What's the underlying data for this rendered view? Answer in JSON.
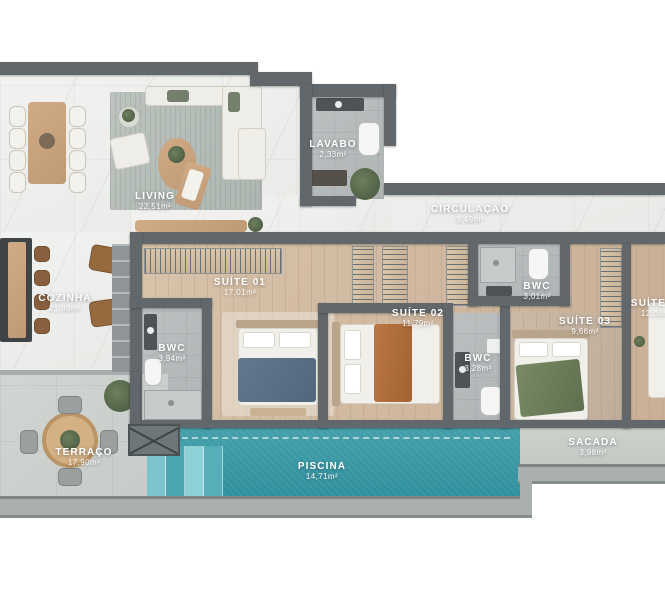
{
  "type": "floor_plan",
  "rooms": [
    {
      "id": "living",
      "label": "LIVING",
      "area": "22,51m²"
    },
    {
      "id": "lavabo",
      "label": "LAVABO",
      "area": "2,33m²"
    },
    {
      "id": "circulacao",
      "label": "CIRCULAÇÃO",
      "area": "9,49m²"
    },
    {
      "id": "cozinha",
      "label": "COZINHA",
      "area": "21,86m²"
    },
    {
      "id": "suite01",
      "label": "SUÍTE 01",
      "area": "17,01m²"
    },
    {
      "id": "bwc_suite01",
      "label": "BWC",
      "area": "3,94m²"
    },
    {
      "id": "suite02",
      "label": "SUÍTE 02",
      "area": "11,79m²"
    },
    {
      "id": "bwc_suite03",
      "label": "BWC",
      "area": "3,01m²"
    },
    {
      "id": "suite03",
      "label": "SUÍTE 03",
      "area": "9,66m²"
    },
    {
      "id": "bwc_suite02",
      "label": "BWC",
      "area": "3,28m²"
    },
    {
      "id": "suite04",
      "label": "SUÍTE 04",
      "area": "12,06m²"
    },
    {
      "id": "terraco",
      "label": "TERRAÇO",
      "area": "17,90m²"
    },
    {
      "id": "piscina",
      "label": "PISCINA",
      "area": "14,71m²"
    },
    {
      "id": "sacada",
      "label": "SACADA",
      "area": "3,98m²"
    }
  ],
  "colors": {
    "wall": "#61676b",
    "marble_floor": "#eef0ed",
    "wood_floor": "#cdb69e",
    "bath_tile": "#b7bbbc",
    "terrace_tile": "#cdd2cf",
    "pool_water": "#3596a3",
    "throw_suite01": "#5b7186",
    "throw_suite02": "#b2703f",
    "throw_suite03": "#70805e",
    "label_text": "#ffffff"
  }
}
